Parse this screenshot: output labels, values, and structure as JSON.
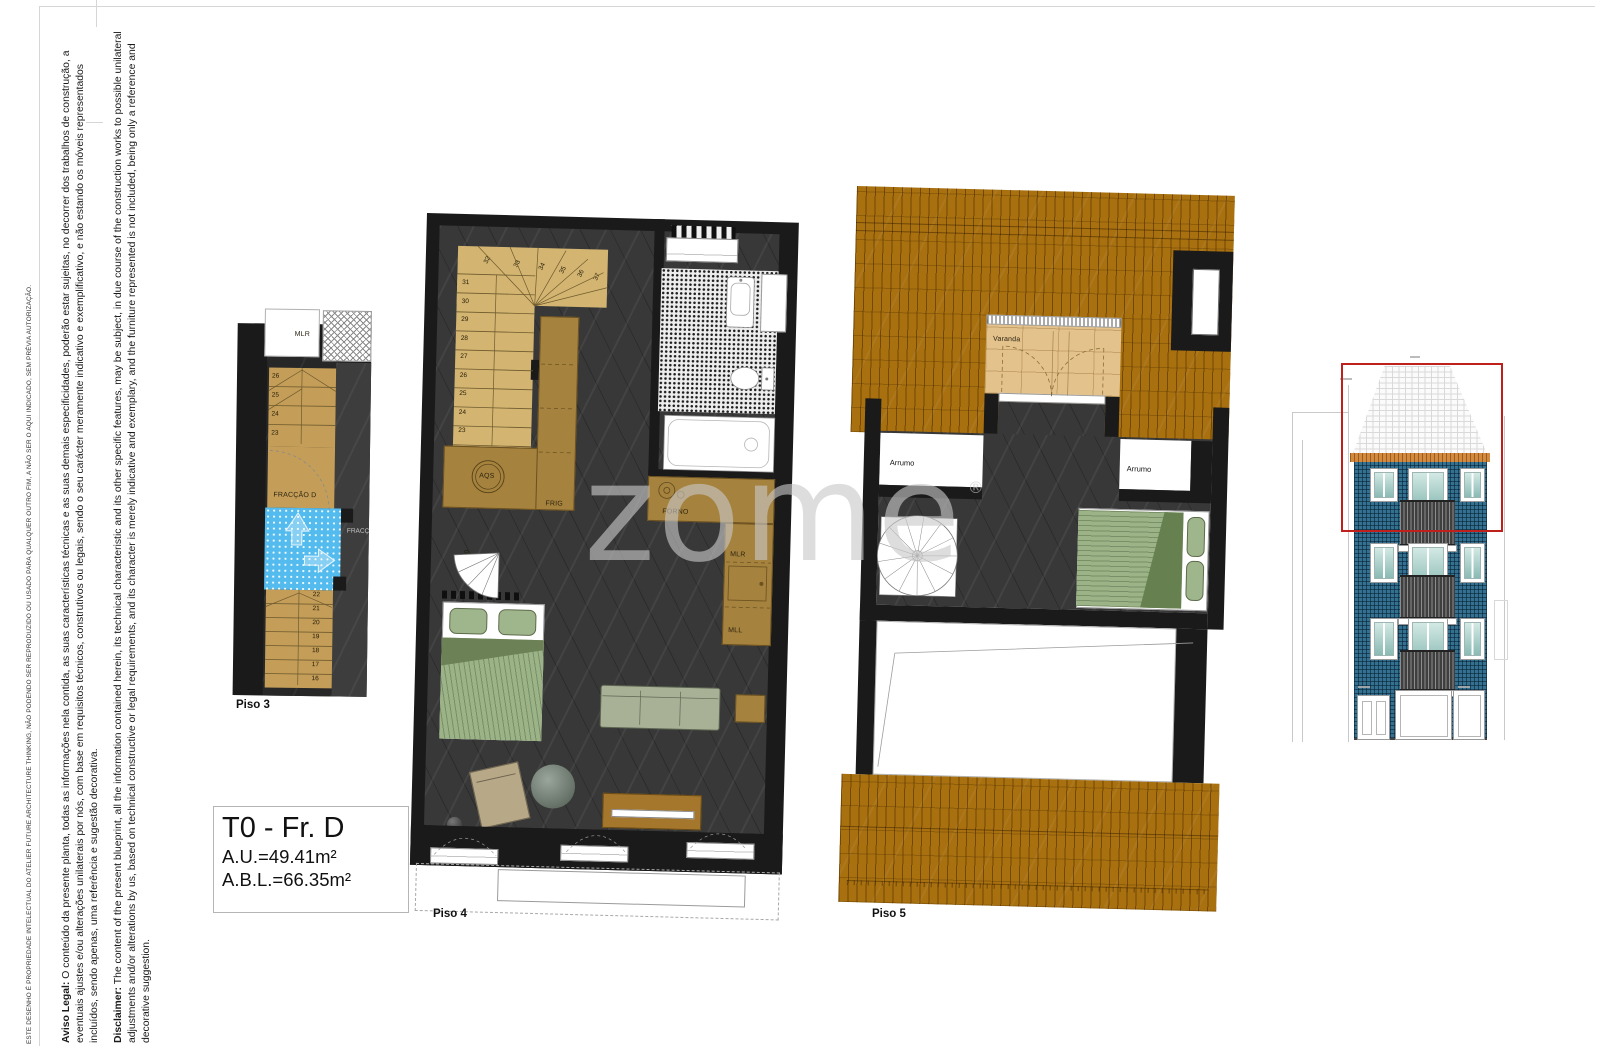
{
  "notes": {
    "copyright": "ESTE  DESENHO É PROPRIEDADE INTELECTUAL DO ATELIER FUTURE ARCHITECTURE THINKING, NÃO PODENDO SER REPRODUZIDO OU USADO PARA QUALQUER OUTRO FIM, A NÃO SER O AQUI INDICADO, SEM PRÉVIA AUTORIZAÇÃO.",
    "aviso_label": "Aviso Legal:",
    "aviso_text": " O conteúdo da presente planta, todas as informações nela contida, as suas características técnicas e as suas demais especificidades, poderão estar sujeitas, no decorrer dos trabalhos de construção, a eventuais ajustes e/ou alterações unilaterais por nós, com base em requisitos técnicos, construtivos ou legais, sendo o seu carácter meramente indicativo e exemplificativo, e não estando os móveis representados incluídos, sendo apenas, uma referência e sugestão decorativa.",
    "disclaimer_label": "Disclaimer:",
    "disclaimer_text": " The content of the present blueprint, all the information contained herein, its technical characteristic and its other specific features, may be subject, in due course of the construction works to possible unilateral adjustments and/or alterations by us, based on technical constructive or legal requirements, and its character is merely indicative and exemplary, and the furniture represented is not included, being only a reference and decorative suggestion."
  },
  "watermark": {
    "text": "zome",
    "registered": "®"
  },
  "title_block": {
    "title": "T0 - Fr. D",
    "line1": "A.U.=49.41m²",
    "line2": "A.B.L.=66.35m²"
  },
  "piso3": {
    "label": "Piso 3",
    "room_mlr": "MLR",
    "fraction": "FRACÇÃO D",
    "adjacent_fraction": "FRACÇ",
    "stairs_upper": [
      "26",
      "25",
      "24",
      "23"
    ],
    "stairs_lower": [
      "22",
      "21",
      "20",
      "19",
      "18",
      "17",
      "16"
    ]
  },
  "piso4": {
    "label": "Piso 4",
    "aqs": "AQS",
    "frig": "FRIG",
    "forno": "FORNO",
    "mlr": "MLR",
    "mll": "MLL",
    "stairs_main": [
      "31",
      "30",
      "29",
      "28",
      "27",
      "26",
      "25",
      "24",
      "23"
    ],
    "stairs_winders": [
      "32",
      "33",
      "34",
      "35",
      "36",
      "37"
    ],
    "stairs_spiral": [
      "01",
      "02",
      "03",
      "04",
      "05"
    ]
  },
  "piso5": {
    "label": "Piso 5",
    "varanda": "Varanda",
    "arrumo_left": "Arrumo",
    "arrumo_right": "Arrumo",
    "stairs_spiral": [
      "01",
      "02",
      "03",
      "04",
      "05",
      "06",
      "07",
      "08",
      "09",
      "10",
      "11",
      "12",
      "13"
    ]
  },
  "colors": {
    "wall_black": "#1a1a1a",
    "floor_dark": "#383838",
    "stair_tan": "#c49e58",
    "stair_tan_light": "#d3b571",
    "kitchen_brown": "#a5823d",
    "roof_brown": "#a8700f",
    "varanda_tan": "#e4c28c",
    "tile_blue": "#54bbee",
    "bed_green": "#9cb387",
    "facade_blue": "#34708f",
    "highlight_red": "#c0201c"
  }
}
